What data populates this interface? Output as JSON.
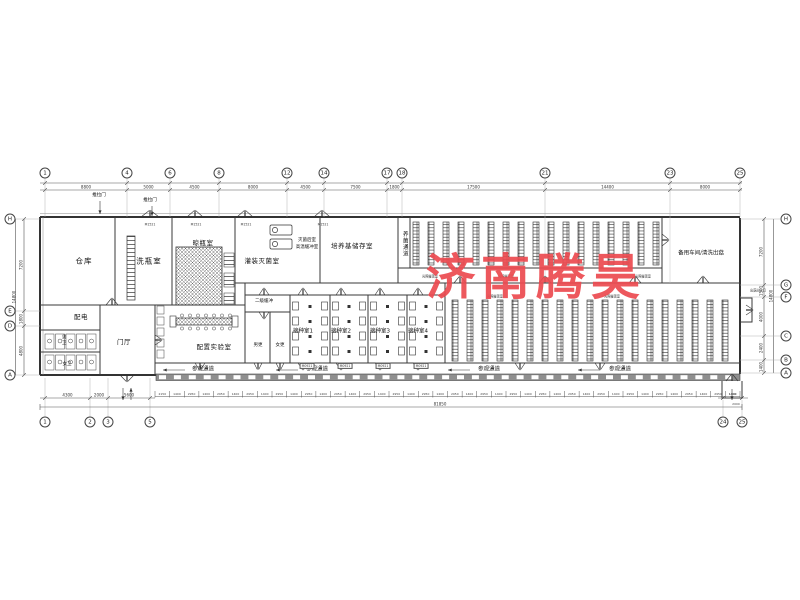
{
  "watermark": {
    "text": "济南腾昊",
    "color": "#ec4a50"
  },
  "rooms": {
    "warehouse": "仓库",
    "wash_room": "洗瓶室",
    "dry_room": "晾瓶室",
    "fill_sterilize": "灌装灭菌室",
    "post_sterilize_1": "灭菌后室",
    "post_sterilize_2": "高温缓冲室",
    "medium_storage": "培养基储存室",
    "spare_workshop": "备用车间/清洗出菇",
    "breeding_channel": "养菌通道",
    "power": "配电",
    "men_wc": "男卫",
    "women_wc": "女卫",
    "hall": "门厅",
    "prep_lab": "配置实验室",
    "buffer2": "二级缓冲",
    "men_change": "男更",
    "women_change": "女更",
    "inoc1": "接种室1",
    "inoc2": "接种室2",
    "inoc3": "接种室3",
    "inoc4": "接种室4",
    "visit": "参观通道"
  },
  "annotations": {
    "sliding_door": "推拉门",
    "door_code": "M1521",
    "small_door_code": "M0921",
    "mushroom_exit": "出菇出入口",
    "light_room": "光照催蕾室"
  },
  "grid": {
    "top_bubbles": [
      "1",
      "4",
      "6",
      "8",
      "12",
      "14",
      "17",
      "18",
      "21",
      "23",
      "25"
    ],
    "top_dims": [
      "8800",
      "5000",
      "4500",
      "8000",
      "4500",
      "7500",
      "1800",
      "17500",
      "14400",
      "8000"
    ],
    "bottom_bubbles": [
      "1",
      "2",
      "3",
      "5",
      "24",
      "25"
    ],
    "bottom_dims": [
      "4300",
      "2000",
      "5600"
    ],
    "bottom_right_dims": [
      "1400",
      "2000"
    ],
    "left_bubbles": [
      "H",
      "E",
      "D",
      "A"
    ],
    "left_dims": [
      "7200",
      "1800",
      "4800"
    ],
    "left_overall": "14800",
    "right_bubbles": [
      "H",
      "G",
      "F",
      "C",
      "B",
      "A"
    ],
    "right_dims": [
      "7200",
      "1500",
      "4000",
      "2400",
      "1400"
    ],
    "right_overall": "14800",
    "overall_width": "81850",
    "window_dims_first": "2150",
    "window_dims_repeat": [
      "1400",
      "2950"
    ]
  }
}
